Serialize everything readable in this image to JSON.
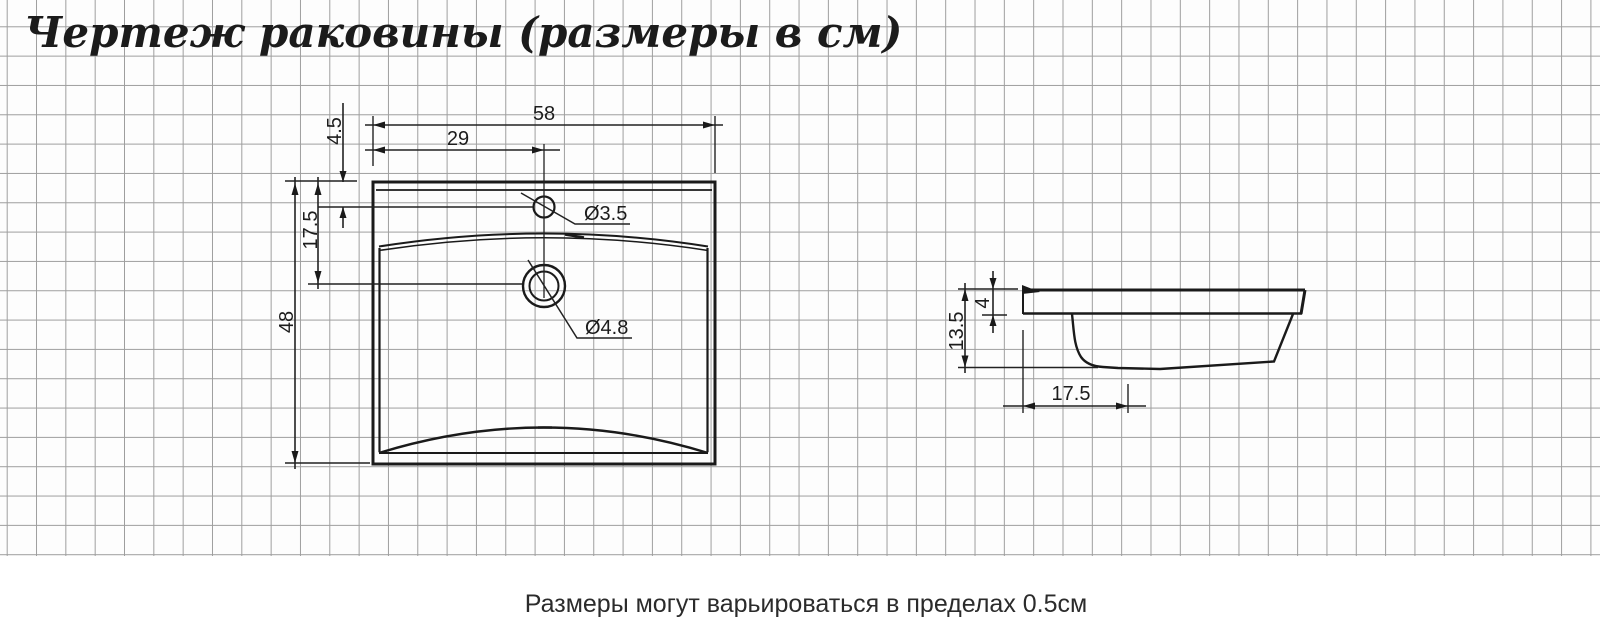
{
  "title": "Чертеж раковины (размеры в см)",
  "note": "Размеры могут варьироваться в пределах 0.5см",
  "front": {
    "overall_width": "58",
    "half_width": "29",
    "faucet_offset": "4.5",
    "drain_depth": "17.5",
    "overall_height": "48",
    "faucet_hole_diameter": "Ø3.5",
    "drain_hole_diameter": "Ø4.8"
  },
  "side": {
    "total_height": "13.5",
    "rim_height": "4",
    "front_depth": "17.5"
  },
  "colors": {
    "line": "#1a1a1a",
    "grid": "#9e9e9e",
    "background": "#ffffff"
  }
}
